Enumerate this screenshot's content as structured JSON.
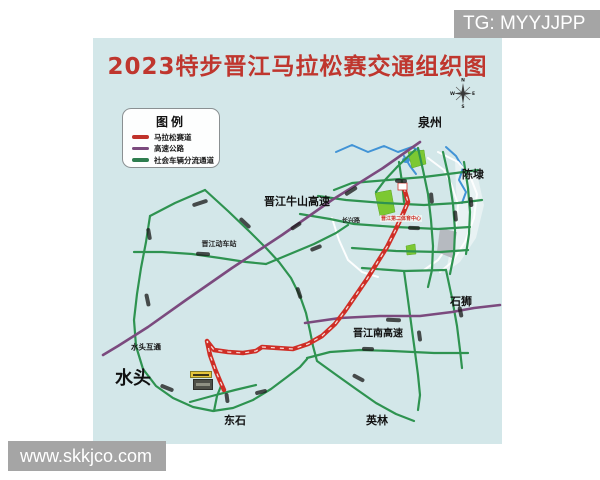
{
  "watermarks": {
    "telegram": "TG: MYYJJPP",
    "website": "www.skkjco.com"
  },
  "map": {
    "title": "2023特步晋江马拉松赛交通组织图",
    "legend": {
      "title": "图例",
      "items": [
        {
          "label": "马拉松赛道",
          "color": "#c0322b"
        },
        {
          "label": "高速公路",
          "color": "#7b4a7e"
        },
        {
          "label": "社会车辆分流通道",
          "color": "#2e7d4f"
        }
      ]
    },
    "compass": {
      "north": "N",
      "west": "W",
      "east": "E",
      "south": "S"
    },
    "place_labels": {
      "quanzhou": "泉州",
      "chendai": "陈埭",
      "shishi": "石狮",
      "shuitou": "水头",
      "dongshi": "东石",
      "yinglin": "英林"
    },
    "road_labels": {
      "niushan_expressway": "晋江牛山高速",
      "south_expressway": "晋江南高速",
      "shuitou_interchange": "水头互通",
      "train_station": "晋江动车站",
      "changxing_road": "长兴路"
    },
    "route_labels": {
      "start_point": "晋江第二体育中心"
    },
    "colors": {
      "map_background": "#d3e7e9",
      "title": "#bf362e",
      "marathon_route": "#cf2e26",
      "expressway": "#7b4a7e",
      "diversion_road": "#2e9350",
      "river": "#4193d6",
      "watermark_badge": "#a5a5a5"
    }
  }
}
